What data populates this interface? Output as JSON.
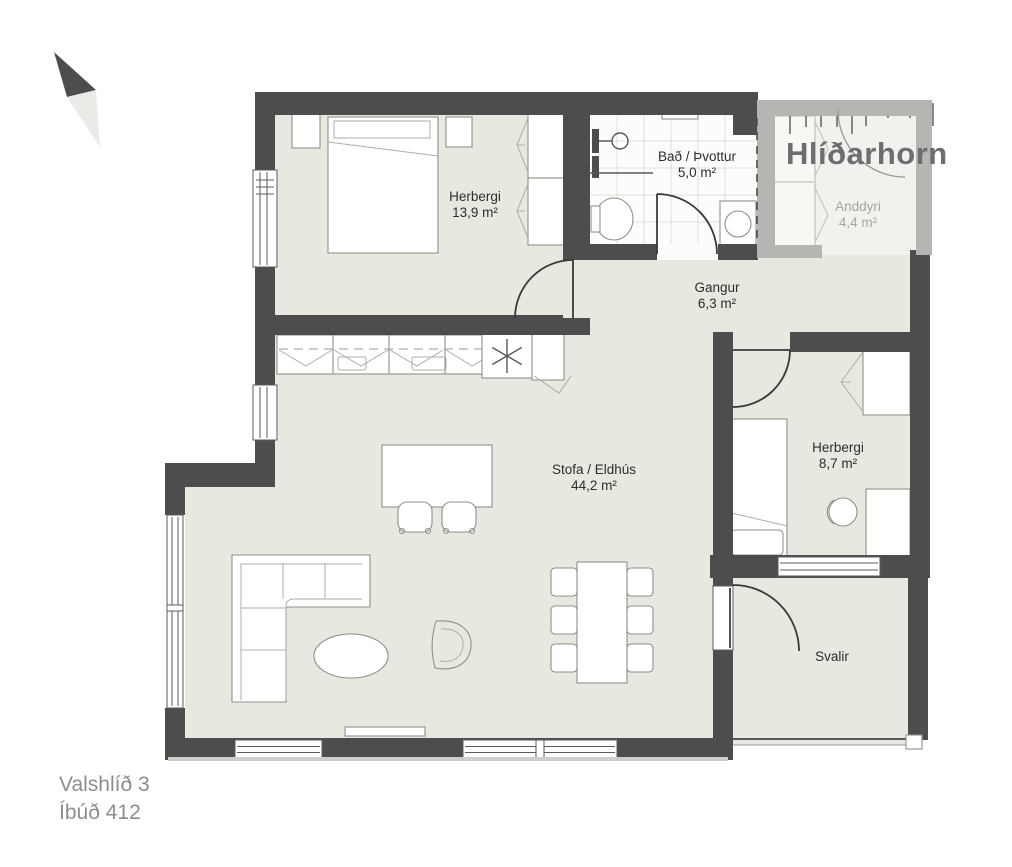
{
  "brand": {
    "logo_text": "Hlíðarhorn"
  },
  "project": {
    "address": "Valshlíð 3",
    "unit": "Íbúð 412"
  },
  "rooms": {
    "herbergi1": {
      "name": "Herbergi",
      "area": "13,9 m²"
    },
    "bad": {
      "name": "Bað / Þvottur",
      "area": "5,0 m²"
    },
    "anddyri": {
      "name": "Anddyri",
      "area": "4,4 m²"
    },
    "gangur": {
      "name": "Gangur",
      "area": "6,3 m²"
    },
    "stofa": {
      "name": "Stofa / Eldhús",
      "area": "44,2 m²"
    },
    "herbergi2": {
      "name": "Herbergi",
      "area": "8,7 m²"
    },
    "svalir": {
      "name": "Svalir"
    }
  },
  "colors": {
    "wall": "#4c4e4e",
    "wall_muted": "#b5b5b2",
    "floor": "#e8e8e0",
    "floor_muted": "#f1f1ee",
    "bath_floor": "#fcfcfa",
    "logo": "#6e6e6e",
    "label": "#2d2d2d",
    "label_muted": "#a5a5a2",
    "footer_text": "#8d8d8d",
    "furniture_stroke": "#90908a",
    "door_stroke": "#3a3a3a"
  }
}
